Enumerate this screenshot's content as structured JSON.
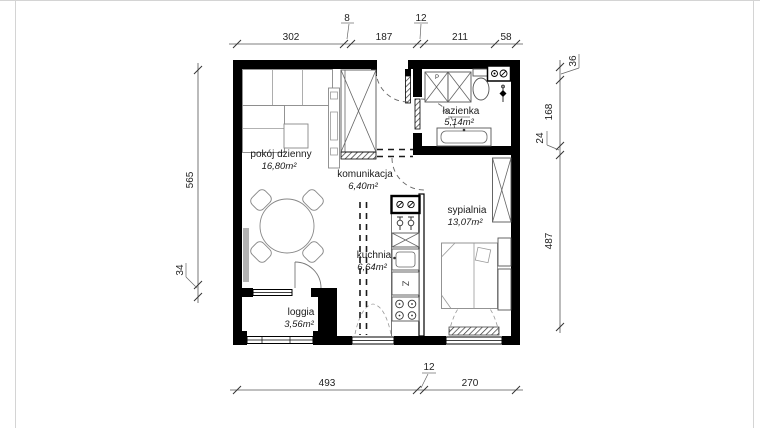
{
  "plan": {
    "rooms": [
      {
        "name": "pokój dzienny",
        "area": "16,80m²"
      },
      {
        "name": "komunikacja",
        "area": "6,40m²"
      },
      {
        "name": "łazienka",
        "area": "5,14m²"
      },
      {
        "name": "sypialnia",
        "area": "13,07m²"
      },
      {
        "name": "kuchnia",
        "area": "6,64m²"
      },
      {
        "name": "loggia",
        "area": "3,56m²"
      }
    ],
    "dimensions": {
      "top": [
        "302",
        "8",
        "187",
        "12",
        "211",
        "58"
      ],
      "left": [
        "565",
        "34"
      ],
      "right": [
        "36",
        "168",
        "24",
        "487"
      ],
      "bottom": [
        "493",
        "12",
        "270"
      ]
    },
    "fixtures": {
      "fridge_label": "Z",
      "washer_label": "P"
    },
    "colors": {
      "wall": "#000000",
      "dimension_text": "#222222",
      "furniture_outline": "#888888",
      "background": "#ffffff"
    }
  }
}
